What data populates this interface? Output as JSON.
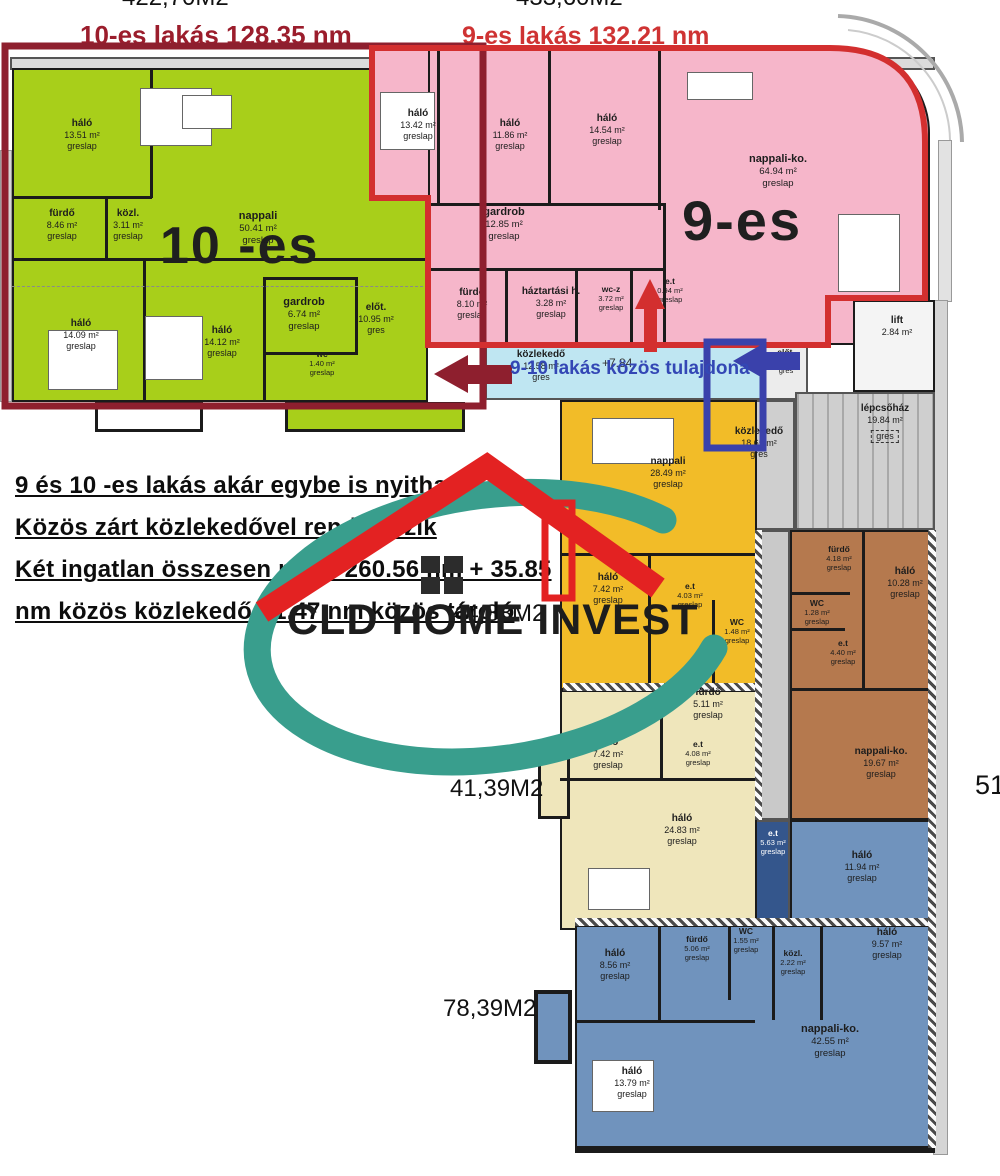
{
  "titles": {
    "apt10": "10-es lakás 128.35 nm",
    "apt9": "9-es lakás 132.21 nm",
    "top_left_partial": "422,70M2",
    "top_right_partial": "433,60M2"
  },
  "apartments": {
    "apt10": {
      "big_label": "10 -es",
      "rooms": [
        {
          "name": "háló",
          "area": "13.51 m²",
          "floor": "greslap"
        },
        {
          "name": "fürdő",
          "area": "8.46 m²",
          "floor": "greslap"
        },
        {
          "name": "közl.",
          "area": "3.11 m²",
          "floor": "greslap"
        },
        {
          "name": "nappali",
          "area": "50.41 m²",
          "floor": "greslap"
        },
        {
          "name": "gardrob",
          "area": "6.74 m²",
          "floor": "greslap"
        },
        {
          "name": "wc",
          "area": "1.40 m²",
          "floor": "greslap"
        },
        {
          "name": "előt.",
          "area": "10.95 m²",
          "floor": "gres"
        },
        {
          "name": "háló",
          "area": "14.09 m²",
          "floor": "greslap"
        },
        {
          "name": "háló",
          "area": "14.12 m²",
          "floor": "greslap"
        }
      ]
    },
    "apt9": {
      "big_label": "9-es",
      "rooms": [
        {
          "name": "háló",
          "area": "13.42 m²",
          "floor": "greslap"
        },
        {
          "name": "háló",
          "area": "11.86 m²",
          "floor": "greslap"
        },
        {
          "name": "háló",
          "area": "14.54 m²",
          "floor": "greslap"
        },
        {
          "name": "gardrob",
          "area": "12.85 m²",
          "floor": "greslap"
        },
        {
          "name": "fürdő",
          "area": "8.10 m²",
          "floor": "greslap"
        },
        {
          "name": "háztartási h.",
          "area": "3.28 m²",
          "floor": "greslap"
        },
        {
          "name": "wc-z",
          "area": "3.72 m²",
          "floor": "greslap"
        },
        {
          "name": "e.t",
          "area": "0.94 m²",
          "floor": "greslap"
        },
        {
          "name": "nappali-ko.",
          "area": "64.94 m²",
          "floor": "greslap"
        }
      ]
    },
    "apt_yellow": {
      "area_label": "44,88M2",
      "rooms": [
        {
          "name": "nappali",
          "area": "28.49 m²",
          "floor": "greslap"
        },
        {
          "name": "háló",
          "area": "7.42 m²",
          "floor": "greslap"
        },
        {
          "name": "e.t",
          "area": "4.03 m²",
          "floor": "greslap"
        },
        {
          "name": "WC",
          "area": "1.48 m²",
          "floor": "greslap"
        }
      ]
    },
    "apt_beige": {
      "area_label": "41,39M2",
      "rooms": [
        {
          "name": "fürdő",
          "area": "5.11 m²",
          "floor": "greslap"
        },
        {
          "name": "háló",
          "area": "7.42 m²",
          "floor": "greslap"
        },
        {
          "name": "e.t",
          "area": "4.08 m²",
          "floor": "greslap"
        },
        {
          "name": "háló",
          "area": "24.83 m²",
          "floor": "greslap"
        },
        {
          "name": "e.t",
          "area": "5.63 m²",
          "floor": "greslap"
        }
      ]
    },
    "apt_brown": {
      "area_label_partial": "51",
      "rooms": [
        {
          "name": "fürdő",
          "area": "4.18 m²",
          "floor": "greslap"
        },
        {
          "name": "WC",
          "area": "1.28 m²",
          "floor": "greslap"
        },
        {
          "name": "e.t",
          "area": "4.40 m²",
          "floor": "greslap"
        },
        {
          "name": "háló",
          "area": "10.28 m²",
          "floor": "greslap"
        },
        {
          "name": "nappali-ko.",
          "area": "19.67 m²",
          "floor": "greslap"
        }
      ]
    },
    "apt_blue": {
      "area_label": "78,39M2",
      "rooms": [
        {
          "name": "háló",
          "area": "11.94 m²",
          "floor": "greslap"
        },
        {
          "name": "háló",
          "area": "8.56 m²",
          "floor": "greslap"
        },
        {
          "name": "fürdő",
          "area": "5.06 m²",
          "floor": "greslap"
        },
        {
          "name": "WC",
          "area": "1.55 m²",
          "floor": "greslap"
        },
        {
          "name": "közl.",
          "area": "2.22 m²",
          "floor": "greslap"
        },
        {
          "name": "háló",
          "area": "9.57 m²",
          "floor": "greslap"
        },
        {
          "name": "nappali-ko.",
          "area": "42.55 m²",
          "floor": "greslap"
        },
        {
          "name": "háló",
          "area": "13.79 m²",
          "floor": "greslap"
        }
      ]
    }
  },
  "common_areas": {
    "corridor_shared": {
      "name": "közlekedő",
      "area": "12.58 m²",
      "floor": "gres"
    },
    "elot": {
      "name": "előt.",
      "area": "5.14 m²",
      "floor": "gres"
    },
    "lift": {
      "name": "lift",
      "area": "2.84 m²"
    },
    "stairs": {
      "name": "lépcsőház",
      "area": "19.84 m²",
      "floor": "gres"
    },
    "corridor_main": {
      "name": "közlekedő",
      "area": "18.65 m²",
      "floor": "gres"
    }
  },
  "annotations": {
    "line1": "9 és 10 -es lakás akár egybe is nyitható",
    "line2": "Közös zárt közlekedővel rendelkezik",
    "line3": "Két ingatlan összesen nettó 260.56 nm + 35.85",
    "line4": "nm közös közlekedő+ 1.47 nm közös tároló",
    "shared_banner": "9-10 lakás közös tulajdona",
    "level_mark": "+7.84"
  },
  "logo": {
    "text": "CLD HOME INVEST"
  },
  "colors": {
    "apt10_green": "#a8cf1a",
    "apt9_pink": "#f6b6ca",
    "shared_cyan": "#bfe6f2",
    "apt_yellow": "#f2bc28",
    "apt_beige": "#efe6bb",
    "apt_brown": "#b5794e",
    "apt_blue": "#7093bd",
    "dark_blue": "#34568c",
    "outline_apt10": "#8e1f2e",
    "outline_apt9": "#d32f2f",
    "outline_shared": "#3a41ab",
    "logo_teal": "#399e8d",
    "logo_red": "#e32222"
  }
}
